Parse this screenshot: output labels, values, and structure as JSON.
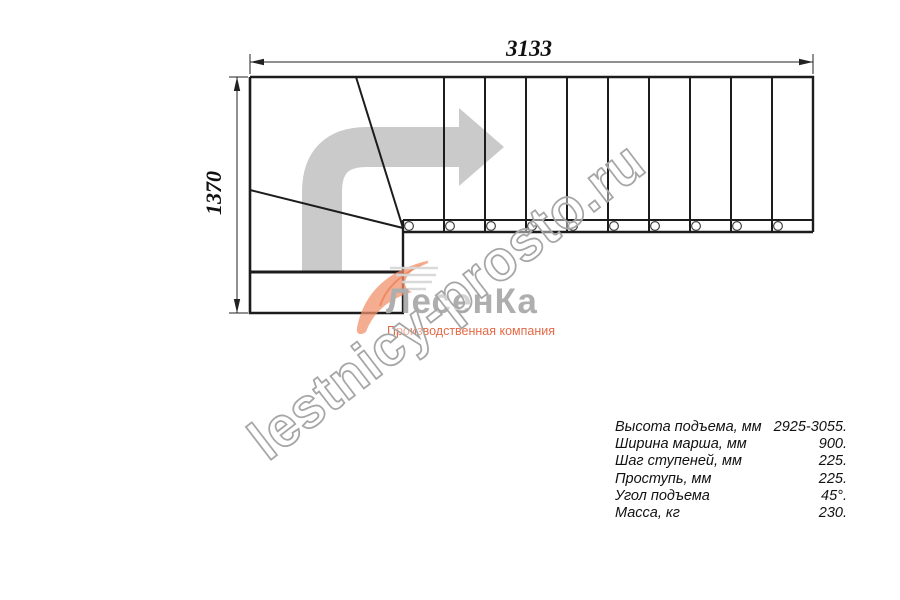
{
  "dimensions": {
    "width_mm": "3133",
    "height_mm": "1370"
  },
  "watermark": {
    "text": "lestnicy-prosto.ru"
  },
  "logo": {
    "name": "ЛесенКа",
    "subtitle": "Производственная компания"
  },
  "specs": {
    "rows": [
      {
        "label": "Высота подъема, мм",
        "value": "2925-3055."
      },
      {
        "label": "Ширина марша, мм",
        "value": "900."
      },
      {
        "label": "Шаг ступеней, мм",
        "value": "225."
      },
      {
        "label": "Проступь, мм",
        "value": "225."
      },
      {
        "label": "Угол подъема",
        "value": "45°."
      },
      {
        "label": "Масса, кг",
        "value": "230."
      }
    ]
  },
  "colors": {
    "line": "#1c1c1c",
    "arrow_grey": "#cacaca",
    "watermark_outline": "#a6a6a6",
    "logo_grey": "#aeaeae",
    "logo_orange": "#f2926c",
    "subtitle_orange": "#e56a47"
  }
}
